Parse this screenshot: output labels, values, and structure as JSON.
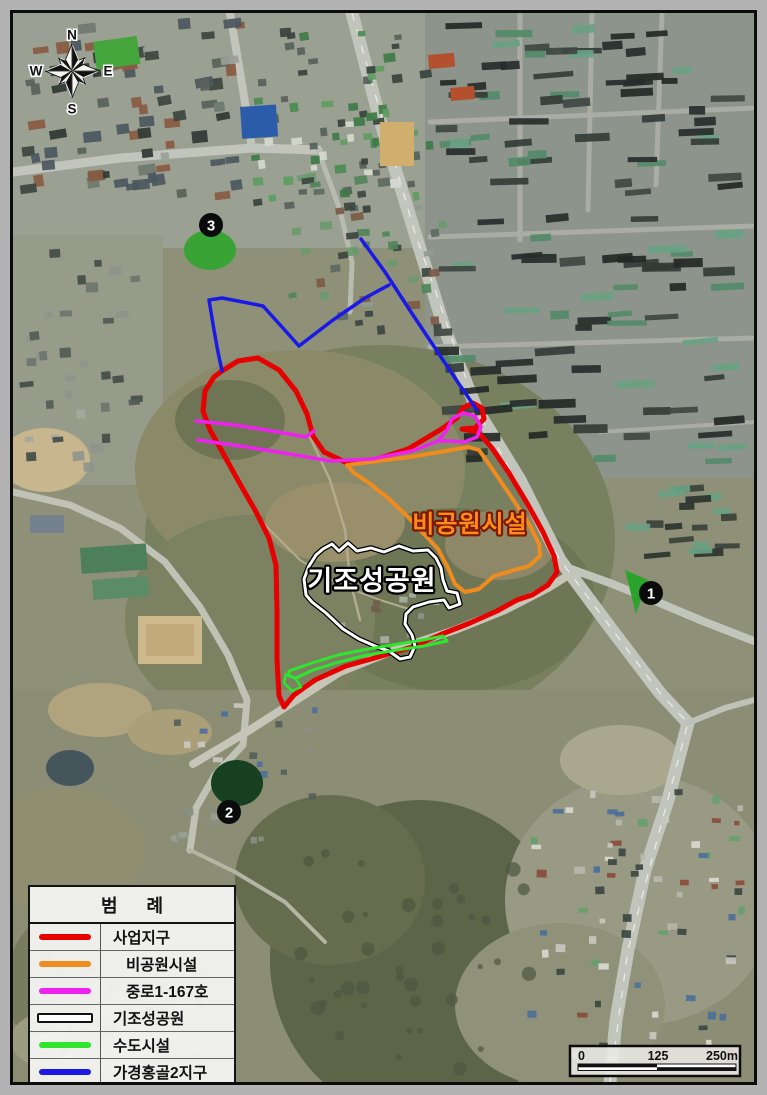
{
  "legend": {
    "title": "범 례",
    "rows": [
      {
        "label": "사업지구",
        "color": "#e60000",
        "style": "solid",
        "indent": false
      },
      {
        "label": "비공원시설",
        "color": "#f08c1e",
        "style": "solid",
        "indent": true
      },
      {
        "label": "중로1-167호",
        "color": "#ee22ee",
        "style": "solid",
        "indent": true
      },
      {
        "label": "기조성공원",
        "color": "#ffffff",
        "style": "outline",
        "indent": false
      },
      {
        "label": "수도시설",
        "color": "#2ee62e",
        "style": "solid",
        "indent": false
      },
      {
        "label": "가경홍골2지구",
        "color": "#1a1ae6",
        "style": "solid",
        "indent": false
      }
    ]
  },
  "map_labels": [
    {
      "id": "nonpark-facility",
      "text": "비공원시설",
      "x": 470,
      "y": 532,
      "fill": "#ff8c1a",
      "outline": "#7c1a00",
      "size": 24
    },
    {
      "id": "existing-park",
      "text": "기조성공원",
      "x": 372,
      "y": 590,
      "fill": "#ffffff",
      "outline": "#000000",
      "size": 27
    }
  ],
  "markers": [
    {
      "label": "1",
      "x": 651,
      "y": 593
    },
    {
      "label": "2",
      "x": 229,
      "y": 812
    },
    {
      "label": "3",
      "x": 211,
      "y": 225
    }
  ],
  "compass": {
    "n": "N",
    "e": "E",
    "s": "S",
    "w": "W"
  },
  "scalebar": {
    "start": "0",
    "mid": "125",
    "end": "250m"
  },
  "overlays": [
    {
      "name": "사업지구",
      "color": "#e60000",
      "width": 5,
      "closed": true,
      "points": [
        [
          222,
          371
        ],
        [
          238,
          361
        ],
        [
          258,
          358
        ],
        [
          279,
          370
        ],
        [
          296,
          391
        ],
        [
          307,
          414
        ],
        [
          313,
          436
        ],
        [
          324,
          452
        ],
        [
          347,
          463
        ],
        [
          377,
          459
        ],
        [
          408,
          449
        ],
        [
          440,
          430
        ],
        [
          457,
          418
        ],
        [
          463,
          408
        ],
        [
          473,
          403
        ],
        [
          482,
          408
        ],
        [
          484,
          419
        ],
        [
          475,
          428
        ],
        [
          462,
          429
        ],
        [
          478,
          432
        ],
        [
          492,
          448
        ],
        [
          509,
          473
        ],
        [
          527,
          503
        ],
        [
          543,
          532
        ],
        [
          554,
          556
        ],
        [
          557,
          572
        ],
        [
          548,
          585
        ],
        [
          532,
          595
        ],
        [
          517,
          600
        ],
        [
          497,
          611
        ],
        [
          470,
          623
        ],
        [
          442,
          634
        ],
        [
          412,
          647
        ],
        [
          378,
          657
        ],
        [
          346,
          666
        ],
        [
          315,
          680
        ],
        [
          294,
          695
        ],
        [
          284,
          707
        ],
        [
          279,
          696
        ],
        [
          277,
          660
        ],
        [
          277,
          612
        ],
        [
          276,
          565
        ],
        [
          269,
          538
        ],
        [
          255,
          510
        ],
        [
          240,
          484
        ],
        [
          224,
          455
        ],
        [
          210,
          430
        ],
        [
          203,
          411
        ],
        [
          205,
          391
        ],
        [
          214,
          377
        ]
      ]
    },
    {
      "name": "비공원시설",
      "color": "#f08c1e",
      "width": 4,
      "closed": true,
      "points": [
        [
          347,
          465
        ],
        [
          378,
          461
        ],
        [
          410,
          457
        ],
        [
          440,
          452
        ],
        [
          468,
          447
        ],
        [
          479,
          450
        ],
        [
          493,
          470
        ],
        [
          512,
          498
        ],
        [
          529,
          524
        ],
        [
          539,
          544
        ],
        [
          540,
          556
        ],
        [
          529,
          566
        ],
        [
          511,
          571
        ],
        [
          494,
          576
        ],
        [
          479,
          589
        ],
        [
          465,
          592
        ],
        [
          455,
          584
        ],
        [
          448,
          568
        ],
        [
          438,
          549
        ],
        [
          424,
          534
        ],
        [
          407,
          516
        ],
        [
          388,
          498
        ],
        [
          369,
          483
        ],
        [
          354,
          473
        ]
      ]
    },
    {
      "name": "중로1-167호-북측선",
      "color": "#ee22ee",
      "width": 3.5,
      "closed": false,
      "points": [
        [
          196,
          421
        ],
        [
          235,
          425
        ],
        [
          272,
          431
        ],
        [
          306,
          437
        ],
        [
          314,
          431
        ]
      ]
    },
    {
      "name": "중로1-167호-본선",
      "color": "#ee22ee",
      "width": 3.5,
      "closed": false,
      "points": [
        [
          198,
          440
        ],
        [
          240,
          446
        ],
        [
          284,
          453
        ],
        [
          330,
          461
        ],
        [
          372,
          459
        ],
        [
          412,
          451
        ],
        [
          438,
          441
        ]
      ]
    },
    {
      "name": "중로1-167호-회전부",
      "color": "#ee22ee",
      "width": 3.5,
      "closed": true,
      "points": [
        [
          438,
          441
        ],
        [
          447,
          430
        ],
        [
          452,
          419
        ],
        [
          463,
          413
        ],
        [
          475,
          416
        ],
        [
          481,
          427
        ],
        [
          477,
          437
        ],
        [
          464,
          442
        ],
        [
          450,
          441
        ]
      ]
    },
    {
      "name": "기조성공원",
      "color": "#ffffff",
      "casing": "#000000",
      "width": 3,
      "closed": true,
      "points": [
        [
          306,
          595
        ],
        [
          304,
          579
        ],
        [
          309,
          566
        ],
        [
          316,
          555
        ],
        [
          323,
          549
        ],
        [
          332,
          544
        ],
        [
          339,
          551
        ],
        [
          348,
          543
        ],
        [
          357,
          551
        ],
        [
          371,
          548
        ],
        [
          384,
          552
        ],
        [
          399,
          546
        ],
        [
          413,
          551
        ],
        [
          428,
          550
        ],
        [
          436,
          558
        ],
        [
          441,
          568
        ],
        [
          443,
          580
        ],
        [
          447,
          591
        ],
        [
          457,
          593
        ],
        [
          460,
          604
        ],
        [
          449,
          608
        ],
        [
          444,
          600
        ],
        [
          429,
          602
        ],
        [
          413,
          607
        ],
        [
          406,
          614
        ],
        [
          405,
          624
        ],
        [
          412,
          635
        ],
        [
          415,
          646
        ],
        [
          410,
          657
        ],
        [
          400,
          659
        ],
        [
          389,
          651
        ],
        [
          375,
          646
        ],
        [
          359,
          639
        ],
        [
          343,
          629
        ],
        [
          326,
          613
        ],
        [
          312,
          602
        ]
      ]
    },
    {
      "name": "수도시설",
      "color": "#2ee62e",
      "width": 3,
      "closed": true,
      "points": [
        [
          289,
          671
        ],
        [
          312,
          663
        ],
        [
          338,
          655
        ],
        [
          368,
          649
        ],
        [
          398,
          644
        ],
        [
          423,
          640
        ],
        [
          443,
          636
        ],
        [
          447,
          641
        ],
        [
          424,
          646
        ],
        [
          397,
          650
        ],
        [
          367,
          655
        ],
        [
          339,
          662
        ],
        [
          313,
          670
        ],
        [
          296,
          678
        ],
        [
          289,
          676
        ]
      ]
    },
    {
      "name": "수도시설-소구역",
      "color": "#2ee62e",
      "width": 2.5,
      "closed": true,
      "points": [
        [
          286,
          674
        ],
        [
          296,
          679
        ],
        [
          301,
          687
        ],
        [
          292,
          691
        ],
        [
          284,
          683
        ]
      ]
    },
    {
      "name": "가경홍골2지구-간선",
      "color": "#1a1ae6",
      "width": 3.5,
      "closed": false,
      "points": [
        [
          361,
          239
        ],
        [
          385,
          272
        ],
        [
          411,
          312
        ],
        [
          437,
          351
        ],
        [
          459,
          384
        ],
        [
          477,
          410
        ]
      ]
    },
    {
      "name": "가경홍골2지구-경계",
      "color": "#1a1ae6",
      "width": 3.5,
      "closed": false,
      "points": [
        [
          389,
          285
        ],
        [
          365,
          298
        ],
        [
          333,
          320
        ],
        [
          299,
          346
        ],
        [
          282,
          327
        ],
        [
          263,
          306
        ],
        [
          243,
          302
        ],
        [
          222,
          298
        ],
        [
          209,
          300
        ],
        [
          214,
          330
        ],
        [
          218,
          352
        ],
        [
          222,
          371
        ]
      ]
    }
  ]
}
